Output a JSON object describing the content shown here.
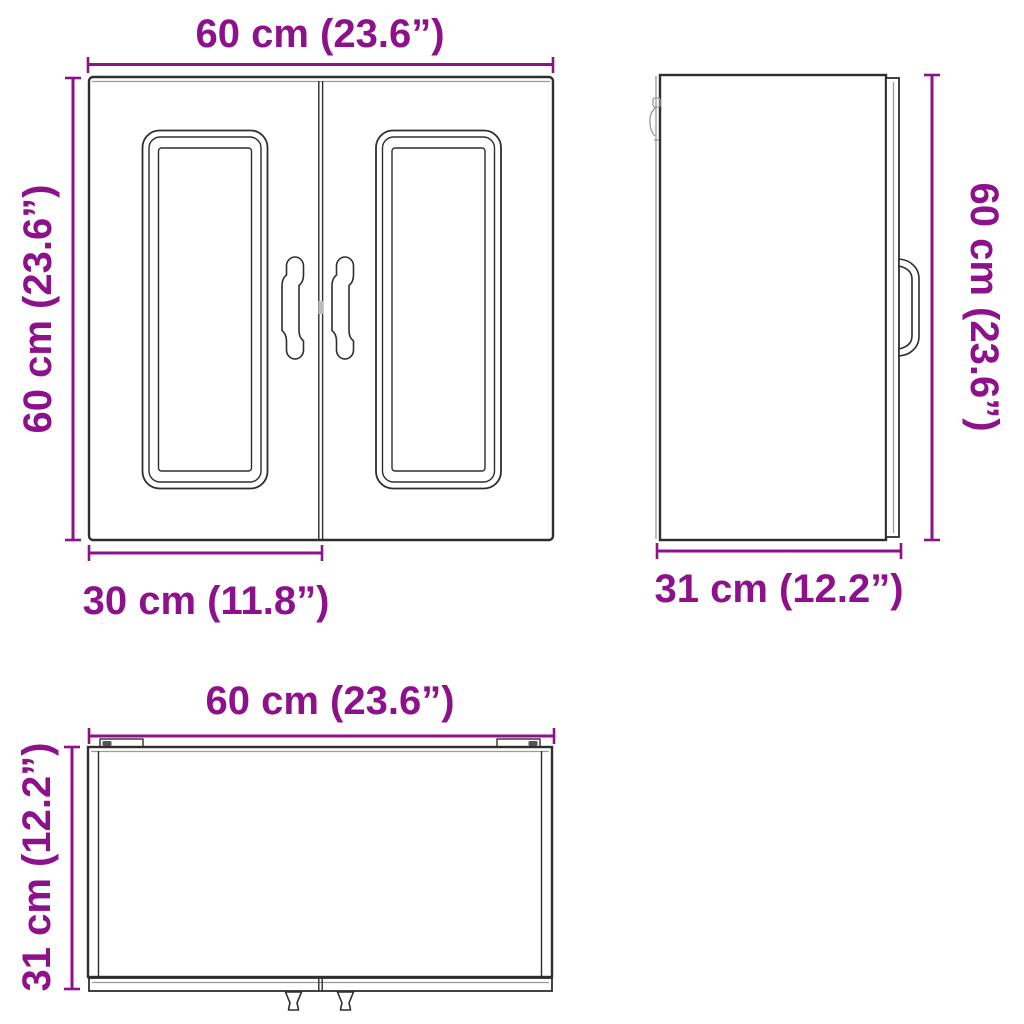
{
  "colors": {
    "dimension": "#8E118C",
    "line_dark": "#2e2e2e",
    "line_light": "#9a9a9a",
    "background": "#ffffff"
  },
  "diagram": {
    "views": {
      "front": {
        "width_label": "60 cm (23.6”)",
        "height_label": "60 cm (23.6”)",
        "door_width_label": "30 cm (11.8”)"
      },
      "side": {
        "height_label": "60 cm (23.6”)",
        "depth_label": "31 cm (12.2”)"
      },
      "top": {
        "width_label": "60 cm (23.6”)",
        "depth_label": "31 cm (12.2”)"
      }
    }
  }
}
